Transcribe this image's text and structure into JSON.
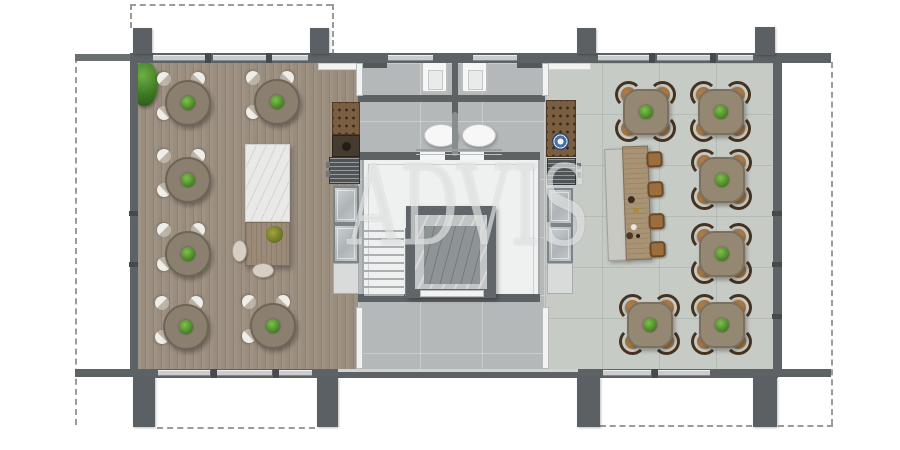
{
  "watermark": {
    "text": "ADVIS"
  },
  "palette": {
    "wall": "#5d6265",
    "wood_floor": "#9a8d7e",
    "concrete_floor": "#b5b8b9",
    "tile_floor": "#c7cbc6",
    "round_table": "#8b7f70",
    "square_table": "#958873",
    "white_chair": "#eeede8",
    "brown_chair": "#9e7242",
    "plant_green": "#55913a",
    "wine_rack": "#7a5e41",
    "blue_plate": "#4a6fa5",
    "marble": "#e9eae8",
    "stool": "#9c6e3e"
  },
  "structure": {
    "columns": [
      [
        133,
        28,
        19,
        26
      ],
      [
        310,
        28,
        19,
        26
      ],
      [
        577,
        28,
        19,
        26
      ],
      [
        755,
        27,
        20,
        28
      ],
      [
        133,
        377,
        22,
        50
      ],
      [
        317,
        377,
        21,
        50
      ],
      [
        577,
        377,
        23,
        50
      ],
      [
        753,
        377,
        24,
        50
      ]
    ],
    "top_windows": [
      [
        153,
        54
      ],
      [
        213,
        54
      ],
      [
        272,
        36
      ],
      [
        388,
        45
      ],
      [
        473,
        44
      ],
      [
        598,
        53
      ],
      [
        657,
        55
      ],
      [
        718,
        35
      ]
    ],
    "bottom_windows": [
      [
        158,
        52
      ],
      [
        214,
        58
      ],
      [
        277,
        35
      ],
      [
        603,
        48
      ],
      [
        656,
        54
      ]
    ],
    "top_mullions": [
      205,
      266,
      649,
      710
    ],
    "bottom_mullions": [
      211,
      273,
      652
    ],
    "left_wall_ticks": [
      211,
      262
    ],
    "right_wall_ticks": [
      211,
      262,
      314
    ],
    "stair_treads": 9
  },
  "furniture": {
    "round_tables": [
      [
        188,
        103
      ],
      [
        277,
        102
      ],
      [
        188,
        180
      ],
      [
        188,
        254
      ],
      [
        186,
        327
      ],
      [
        273,
        326
      ]
    ],
    "square_tables": [
      [
        646,
        112
      ],
      [
        721,
        112
      ],
      [
        722,
        180
      ],
      [
        722,
        254
      ],
      [
        650,
        325
      ],
      [
        722,
        325
      ]
    ],
    "communal_stools": [
      [
        44,
        6
      ],
      [
        44,
        36
      ],
      [
        44,
        68
      ],
      [
        44,
        96
      ]
    ],
    "tableware": [
      [
        24,
        50,
        7,
        "#3d2b1c"
      ],
      [
        29,
        62,
        6,
        "#b08b3e"
      ],
      [
        26,
        78,
        6,
        "#e8e6e0"
      ],
      [
        21,
        86,
        7,
        "#4a3828"
      ],
      [
        31,
        88,
        4,
        "#2e2218"
      ]
    ]
  }
}
